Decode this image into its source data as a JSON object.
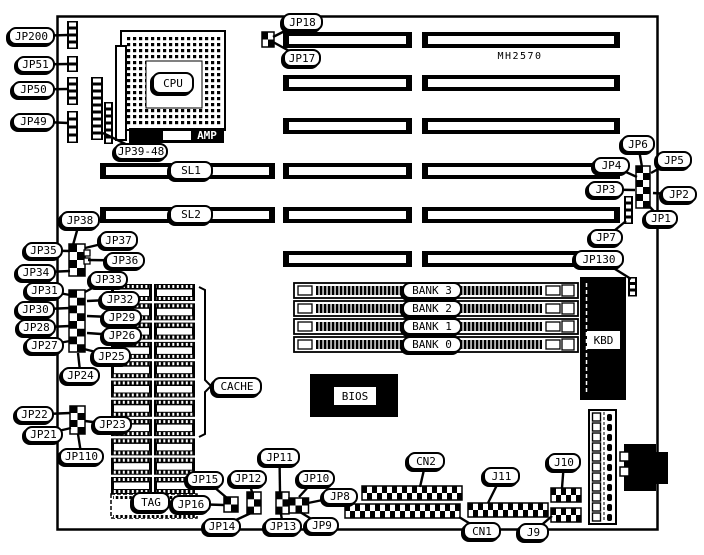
{
  "board": {
    "model": "MH2570",
    "foreground": "#000000",
    "background": "#ffffff"
  },
  "labels": {
    "jp200": "JP200",
    "jp51": "JP51",
    "jp50": "JP50",
    "jp49": "JP49",
    "jp39_48": "JP39-48",
    "jp18": "JP18",
    "jp17": "JP17",
    "mh2570": "MH2570",
    "jp6": "JP6",
    "jp5": "JP5",
    "jp4": "JP4",
    "jp3": "JP3",
    "jp2": "JP2",
    "jp1": "JP1",
    "jp7": "JP7",
    "jp130": "JP130",
    "jp38": "JP38",
    "jp37": "JP37",
    "jp36": "JP36",
    "jp35": "JP35",
    "jp34": "JP34",
    "jp33": "JP33",
    "jp32": "JP32",
    "jp31": "JP31",
    "jp30": "JP30",
    "jp29": "JP29",
    "jp28": "JP28",
    "jp27": "JP27",
    "jp26": "JP26",
    "jp25": "JP25",
    "jp24": "JP24",
    "jp23": "JP23",
    "jp22": "JP22",
    "jp21": "JP21",
    "jp110": "JP110",
    "jp16": "JP16",
    "jp15": "JP15",
    "jp14": "JP14",
    "jp13": "JP13",
    "jp12": "JP12",
    "jp11": "JP11",
    "jp10": "JP10",
    "jp9": "JP9",
    "jp8": "JP8",
    "cn1": "CN1",
    "cn2": "CN2",
    "j9": "J9",
    "j10": "J10",
    "j11": "J11",
    "cache": "CACHE",
    "tag": "TAG",
    "cpu": "CPU",
    "amp": "AMP",
    "sl1": "SL1",
    "sl2": "SL2",
    "bank3": "BANK 3",
    "bank2": "BANK 2",
    "bank1": "BANK 1",
    "bank0": "BANK 0",
    "bios": "BIOS",
    "kbd": "KBD"
  }
}
